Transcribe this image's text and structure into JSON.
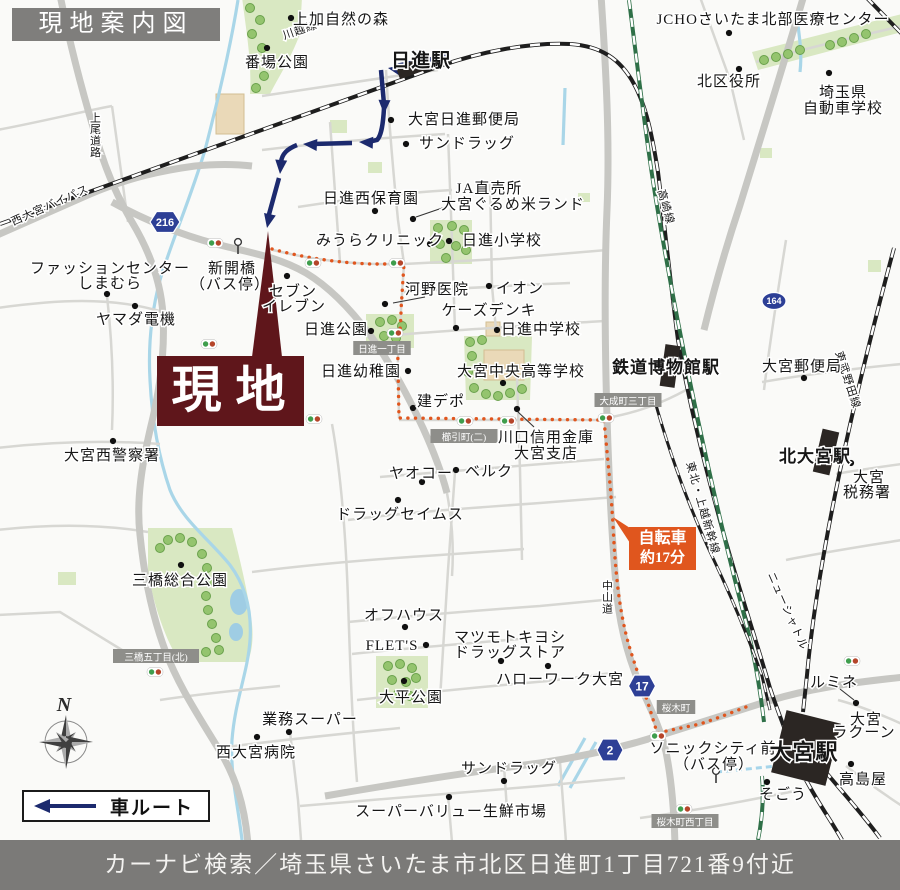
{
  "header": {
    "title": "現地案内図"
  },
  "footer": {
    "text": "カーナビ検索／埼玉県さいたま市北区日進町1丁目721番9付近"
  },
  "site": {
    "label": "現地"
  },
  "legend": {
    "label": "車ルート"
  },
  "bike_badge": {
    "line1": "自転車",
    "line2": "約17分"
  },
  "compass": {
    "label": "N",
    "x": 66,
    "y": 742
  },
  "colors": {
    "site_maroon": "#5f161b",
    "route_navy": "#1c2a6e",
    "bike_orange": "#e0561e",
    "shield_blue": "#2d3f96",
    "bar_gray": "#7b7a78",
    "road_gray": "#c7c7c3",
    "park_green": "#d9e8c2",
    "river_blue": "#a9d6e8",
    "rail_black": "#1e1e1e",
    "shinkansen_green": "#2f7048"
  },
  "map": {
    "roads_major": [
      "M60,-5 C72,55 86,105 100,150 C108,175 118,198 132,222 C150,252 161,282 163,315 C165,350 160,390 150,430 C142,465 136,500 140,535 C144,575 152,615 165,650 C178,685 198,715 218,748 C235,775 245,805 248,845",
      "M-5,236 L90,194 C130,177 165,170 195,166 C215,164 235,164 252,166",
      "M112,202 C152,224 190,238 228,247 C258,254 282,259 306,273 C331,288 352,311 370,335 C392,365 409,398 423,428 C433,450 441,470 447,493",
      "M601,-5 C606,70 610,140 607,210 C604,280 605,350 607,417 C609,480 612,540 616,585 C619,625 629,662 644,694 C653,714 661,731 666,752 C671,777 674,806 675,845",
      "M325,796 C400,783 470,772 540,763 C580,757 620,748 658,736 C700,723 740,710 772,700 C805,690 845,683 905,677",
      "M804,-5 C782,70 760,140 740,205 C726,247 714,289 704,330"
    ],
    "roads_minor": [
      "M-3,130 C40,122 80,112 112,106",
      "M112,106 L128,222",
      "M262,96 C330,86 380,78 438,70",
      "M-3,308 C55,300 110,296 163,312",
      "M107,296 C112,340 114,385 112,430",
      "M-3,448 C50,442 105,440 160,444",
      "M-3,530 C50,524 100,524 148,532",
      "M330,122 L340,262",
      "M386,70 C388,106 392,160 398,220 L404,264",
      "M262,150 C320,143 380,138 445,134",
      "M298,207 C350,199 400,193 452,190",
      "M273,250 C320,262 365,265 404,264 L500,259 L607,250",
      "M448,134 L452,241 L455,330",
      "M490,180 L492,286 L496,330",
      "M404,292 C450,289 520,285 570,283",
      "M396,335 C450,330 540,325 604,321",
      "M404,264 L401,310 C401,332 397,348 398,368 L399,418",
      "M399,420 L604,420",
      "M607,418 C640,412 664,402 686,390",
      "M332,424 C342,480 346,540 348,600 C350,660 352,720 357,782",
      "M517,378 L520,470 L522,560",
      "M380,477 C440,472 520,466 604,459",
      "M455,472 L448,570 L443,650 L440,700",
      "M348,520 C400,513 470,508 540,503 L616,497",
      "M252,572 C300,566 360,560 440,555 L524,549",
      "M348,622 C400,617 470,611 540,606 L614,599",
      "M352,654 C400,649 460,644 520,639",
      "M357,700 C420,693 480,687 548,681 L612,673",
      "M290,732 L298,800 L301,840",
      "M218,748 C280,740 340,734 400,728",
      "M300,806 C380,799 460,792 540,786 L625,778",
      "M560,762 L566,842",
      "M448,796 L452,842",
      "M504,766 L507,810",
      "M160,700 C200,694 240,690 280,686",
      "M-3,615 L60,612 L122,650",
      "M756,62 C800,50 850,38 902,26",
      "M700,-3 L730,80 L744,140",
      "M762,382 C810,374 860,368 902,364",
      "M836,474 C858,470 880,467 902,464",
      "M786,560 C825,552 865,546 902,540",
      "M838,700 C860,706 880,714 902,724",
      "M846,766 C864,780 884,794 902,806",
      "M640,818 C700,810 750,800 800,790",
      "M786,240 C778,290 770,340 764,390",
      "M447,493 C452,520 454,548 452,576"
    ],
    "railways": [
      {
        "d": "M0,224 L440,66 C480,52 530,42 570,44 C600,46 620,58 634,84 C646,106 652,134 658,172 C664,220 670,280 678,340 C690,408 706,470 724,535 C740,592 756,640 770,688 C778,712 785,730 792,748",
        "k": "jr"
      },
      {
        "d": "M629,0 C638,70 646,140 656,200 C668,272 682,345 698,420 C712,485 728,555 744,615 C754,652 760,688 764,722",
        "k": "sk"
      },
      {
        "d": "M894,248 C872,330 850,420 834,500 C822,560 812,620 807,675 L803,712",
        "k": "jr"
      },
      {
        "d": "M866,-3 L902,34",
        "k": "jr"
      },
      {
        "d": "M654,398 C668,448 688,505 712,556 C730,594 748,636 762,676 L770,710",
        "k": "lrt"
      },
      {
        "d": "M824,770 C845,795 864,816 880,838",
        "k": "jr"
      },
      {
        "d": "M806,780 C820,806 832,822 842,840",
        "k": "jr"
      },
      {
        "d": "M762,776 C764,798 762,820 758,840",
        "k": "sk"
      }
    ],
    "rivers": [
      "M238,0 C230,50 218,100 205,150 C190,200 172,240 160,280 C152,310 148,345 150,380 C152,420 158,455 170,490 C182,520 210,540 230,565 C245,585 252,610 250,640 C248,672 235,700 232,740 C230,775 238,805 242,840",
      "M565,88 L563,145",
      "M797,18 C800,40 802,55 800,72",
      "M585,738 L558,786",
      "M596,742 L570,788"
    ],
    "walk_link": "M716,772 C740,770 765,767 788,765",
    "parks": [
      "M242,-3 L302,-3 L300,34 C290,60 278,78 270,94 L250,94 C252,62 246,30 242,-3 Z",
      "M430,220 L472,220 L472,264 L430,264 Z",
      "M366,314 L414,314 L414,348 L366,348 Z",
      "M464,336 L532,336 L530,400 L466,400 Z",
      "M148,528 L232,528 C240,560 248,592 252,624 C254,644 250,660 246,662 L180,662 C165,640 152,600 148,570 Z",
      "M376,656 L428,656 L428,708 L376,708 Z",
      "M752,52 L902,14 L902,32 L758,70 Z"
    ],
    "green_rects": [
      [
        330,
        120,
        17,
        13
      ],
      [
        368,
        162,
        14,
        11
      ],
      [
        578,
        193,
        12,
        9
      ],
      [
        868,
        260,
        13,
        12
      ],
      [
        58,
        572,
        18,
        13
      ],
      [
        282,
        24,
        14,
        12
      ],
      [
        760,
        148,
        12,
        10
      ]
    ],
    "ponds": [
      [
        239,
        602,
        9,
        13
      ],
      [
        236,
        632,
        7,
        9
      ]
    ],
    "buildings": [
      [
        216,
        94,
        28,
        40
      ],
      [
        484,
        350,
        40,
        30
      ],
      [
        486,
        322,
        14,
        14
      ]
    ],
    "trees": [
      [
        250,
        8
      ],
      [
        260,
        20
      ],
      [
        252,
        34
      ],
      [
        262,
        48
      ],
      [
        254,
        62
      ],
      [
        264,
        76
      ],
      [
        256,
        88
      ],
      [
        438,
        228
      ],
      [
        452,
        226
      ],
      [
        464,
        230
      ],
      [
        440,
        244
      ],
      [
        456,
        246
      ],
      [
        466,
        250
      ],
      [
        446,
        258
      ],
      [
        380,
        322
      ],
      [
        392,
        320
      ],
      [
        402,
        326
      ],
      [
        384,
        336
      ],
      [
        396,
        338
      ],
      [
        470,
        342
      ],
      [
        482,
        340
      ],
      [
        472,
        356
      ],
      [
        468,
        372
      ],
      [
        474,
        388
      ],
      [
        486,
        394
      ],
      [
        498,
        396
      ],
      [
        510,
        393
      ],
      [
        522,
        389
      ],
      [
        168,
        540
      ],
      [
        180,
        538
      ],
      [
        192,
        542
      ],
      [
        202,
        554
      ],
      [
        207,
        568
      ],
      [
        209,
        582
      ],
      [
        206,
        596
      ],
      [
        208,
        610
      ],
      [
        212,
        624
      ],
      [
        216,
        638
      ],
      [
        219,
        650
      ],
      [
        206,
        652
      ],
      [
        160,
        548
      ],
      [
        388,
        666
      ],
      [
        400,
        664
      ],
      [
        412,
        668
      ],
      [
        392,
        680
      ],
      [
        406,
        682
      ],
      [
        416,
        678
      ],
      [
        398,
        694
      ],
      [
        410,
        696
      ],
      [
        764,
        60
      ],
      [
        776,
        57
      ],
      [
        788,
        54
      ],
      [
        800,
        50
      ],
      [
        830,
        45
      ],
      [
        842,
        42
      ],
      [
        854,
        38
      ],
      [
        866,
        34
      ]
    ],
    "bike_route": "M272,249 C305,258 340,263 372,264 L404,264 L401,310 C401,332 397,348 398,368 L399,418 L604,420 C607,452 611,490 613,525 C615,565 618,605 628,642 C636,670 648,700 657,733 L700,724 C718,718 733,712 746,707",
    "car_route": {
      "lines": [
        "M448,56 L396,66",
        "M381,70 L384,104",
        "M384,108 C383,126 381,136 377,140 L368,142",
        "M352,143 L312,144",
        "M297,145 C287,149 282,154 281,162 L280,164",
        "M279,178 L268,218"
      ],
      "arrows": [
        [
          388,
          68,
          190
        ],
        [
          384,
          114,
          92
        ],
        [
          359,
          142,
          183
        ],
        [
          303,
          144,
          184
        ],
        [
          280,
          174,
          95
        ],
        [
          267,
          228,
          102
        ]
      ]
    },
    "site_pointer": "268,231 252,357 282,357",
    "badge_pointer": "630,528 613,517 630,543",
    "stations": [
      [
        412,
        68,
        30,
        13,
        -20
      ],
      [
        670,
        366,
        15,
        42,
        8
      ],
      [
        826,
        452,
        17,
        44,
        13
      ],
      [
        806,
        748,
        56,
        64,
        14
      ]
    ],
    "shields": [
      {
        "n": "216",
        "x": 165,
        "y": 222,
        "k": "hex",
        "w": 30,
        "h": 21,
        "fs": 11
      },
      {
        "n": "164",
        "x": 774,
        "y": 301,
        "k": "oval",
        "w": 24,
        "h": 17,
        "fs": 9
      },
      {
        "n": "17",
        "x": 642,
        "y": 686,
        "k": "hex",
        "w": 27,
        "h": 22,
        "fs": 12
      },
      {
        "n": "2",
        "x": 610,
        "y": 750,
        "k": "hex",
        "w": 26,
        "h": 22,
        "fs": 12
      }
    ],
    "area_tags": [
      [
        "日進一丁目",
        382,
        349
      ],
      [
        "櫛引町(二)",
        464,
        437
      ],
      [
        "大成町三丁目",
        628,
        401
      ],
      [
        "三橋五丁目(北)",
        156,
        657
      ],
      [
        "桜木町",
        676,
        708
      ],
      [
        "桜木町西丁目",
        685,
        822
      ]
    ],
    "signals": [
      [
        215,
        243
      ],
      [
        313,
        263
      ],
      [
        397,
        263
      ],
      [
        395,
        333
      ],
      [
        209,
        344
      ],
      [
        314,
        419
      ],
      [
        465,
        421
      ],
      [
        508,
        421
      ],
      [
        606,
        418
      ],
      [
        155,
        672
      ],
      [
        658,
        736
      ],
      [
        684,
        809
      ],
      [
        852,
        661
      ]
    ],
    "bus_stops": [
      [
        238,
        249
      ],
      [
        716,
        778
      ]
    ],
    "dots": [
      [
        291,
        18
      ],
      [
        267,
        48
      ],
      [
        729,
        33
      ],
      [
        739,
        69
      ],
      [
        829,
        73
      ],
      [
        391,
        120
      ],
      [
        406,
        144
      ],
      [
        375,
        211
      ],
      [
        413,
        219
      ],
      [
        430,
        244
      ],
      [
        449,
        241
      ],
      [
        385,
        304
      ],
      [
        489,
        286
      ],
      [
        456,
        328
      ],
      [
        497,
        330
      ],
      [
        371,
        331
      ],
      [
        287,
        276
      ],
      [
        107,
        294
      ],
      [
        135,
        306
      ],
      [
        113,
        441
      ],
      [
        408,
        371
      ],
      [
        503,
        383
      ],
      [
        413,
        408
      ],
      [
        517,
        409
      ],
      [
        456,
        470
      ],
      [
        422,
        482
      ],
      [
        398,
        500
      ],
      [
        181,
        565
      ],
      [
        405,
        627
      ],
      [
        426,
        645
      ],
      [
        501,
        661
      ],
      [
        548,
        666
      ],
      [
        404,
        681
      ],
      [
        289,
        732
      ],
      [
        257,
        737
      ],
      [
        504,
        781
      ],
      [
        449,
        797
      ],
      [
        804,
        378
      ],
      [
        851,
        463
      ],
      [
        856,
        703
      ],
      [
        851,
        764
      ],
      [
        767,
        782
      ]
    ],
    "leaders": [
      [
        448,
        206,
        416,
        217
      ],
      [
        518,
        412,
        534,
        427
      ],
      [
        425,
        297,
        393,
        303
      ],
      [
        840,
        689,
        854,
        700
      ]
    ],
    "labels": [
      {
        "t": "上加自然の森",
        "x": 341,
        "y": 19
      },
      {
        "t": "番場公園",
        "x": 277,
        "y": 62
      },
      {
        "t": "日進駅",
        "x": 421,
        "y": 60,
        "s": 19,
        "b": 1
      },
      {
        "t": "JCHOさいたま北部医療センター",
        "x": 773,
        "y": 19
      },
      {
        "t": "北区役所",
        "x": 729,
        "y": 81
      },
      {
        "t": "埼玉県",
        "x": 843,
        "y": 92
      },
      {
        "t": "自動車学校",
        "x": 843,
        "y": 108
      },
      {
        "t": "大宮日進郵便局",
        "x": 464,
        "y": 119
      },
      {
        "t": "サンドラッグ",
        "x": 467,
        "y": 143
      },
      {
        "t": "日進西保育園",
        "x": 371,
        "y": 198
      },
      {
        "t": "JA直売所",
        "x": 489,
        "y": 188
      },
      {
        "t": "大宮ぐるめ米ランド",
        "x": 513,
        "y": 204
      },
      {
        "t": "みうらクリニック",
        "x": 380,
        "y": 240
      },
      {
        "t": "日進小学校",
        "x": 502,
        "y": 240
      },
      {
        "t": "河野医院",
        "x": 437,
        "y": 289
      },
      {
        "t": "イオン",
        "x": 520,
        "y": 288
      },
      {
        "t": "ケーズデンキ",
        "x": 489,
        "y": 310
      },
      {
        "t": "日進中学校",
        "x": 541,
        "y": 329
      },
      {
        "t": "日進公園",
        "x": 336,
        "y": 329
      },
      {
        "t": "セブン",
        "x": 293,
        "y": 291
      },
      {
        "t": "イレブン",
        "x": 294,
        "y": 306
      },
      {
        "t": "新開橋",
        "x": 232,
        "y": 268
      },
      {
        "t": "（バス停）",
        "x": 230,
        "y": 284
      },
      {
        "t": "ファッションセンター",
        "x": 110,
        "y": 268
      },
      {
        "t": "しまむら",
        "x": 110,
        "y": 283
      },
      {
        "t": "ヤマダ電機",
        "x": 136,
        "y": 319
      },
      {
        "t": "日進幼稚園",
        "x": 361,
        "y": 371
      },
      {
        "t": "大宮中央高等学校",
        "x": 521,
        "y": 371
      },
      {
        "t": "建デポ",
        "x": 441,
        "y": 401
      },
      {
        "t": "川口信用金庫",
        "x": 546,
        "y": 437
      },
      {
        "t": "大宮支店",
        "x": 546,
        "y": 453
      },
      {
        "t": "ヤオコー",
        "x": 421,
        "y": 473
      },
      {
        "t": "ベルク",
        "x": 489,
        "y": 471
      },
      {
        "t": "ドラッグセイムス",
        "x": 400,
        "y": 514
      },
      {
        "t": "三橋総合公園",
        "x": 180,
        "y": 580
      },
      {
        "t": "オフハウス",
        "x": 404,
        "y": 615
      },
      {
        "t": "FLET'S",
        "x": 392,
        "y": 645
      },
      {
        "t": "マツモトキヨシ",
        "x": 510,
        "y": 637
      },
      {
        "t": "ドラッグストア",
        "x": 510,
        "y": 652
      },
      {
        "t": "ハローワーク大宮",
        "x": 560,
        "y": 679
      },
      {
        "t": "大平公園",
        "x": 411,
        "y": 697
      },
      {
        "t": "業務スーパー",
        "x": 310,
        "y": 719
      },
      {
        "t": "西大宮病院",
        "x": 256,
        "y": 752
      },
      {
        "t": "大宮西警察署",
        "x": 112,
        "y": 455
      },
      {
        "t": "サンドラッグ",
        "x": 509,
        "y": 768
      },
      {
        "t": "スーパーバリュー生鮮市場",
        "x": 451,
        "y": 811
      },
      {
        "t": "鉄道博物館駅",
        "x": 666,
        "y": 367,
        "s": 17,
        "b": 1
      },
      {
        "t": "大宮郵便局",
        "x": 802,
        "y": 366
      },
      {
        "t": "北大宮駅",
        "x": 815,
        "y": 456,
        "s": 17,
        "b": 1
      },
      {
        "t": "大宮",
        "x": 869,
        "y": 477
      },
      {
        "t": "税務署",
        "x": 867,
        "y": 492
      },
      {
        "t": "ルミネ",
        "x": 834,
        "y": 682
      },
      {
        "t": "大宮",
        "x": 866,
        "y": 719
      },
      {
        "t": "ラクーン",
        "x": 864,
        "y": 732
      },
      {
        "t": "高島屋",
        "x": 863,
        "y": 779
      },
      {
        "t": "そごう",
        "x": 783,
        "y": 794
      },
      {
        "t": "ソニックシティ前",
        "x": 713,
        "y": 748
      },
      {
        "t": "（バス停）",
        "x": 714,
        "y": 764
      },
      {
        "t": "大宮駅",
        "x": 804,
        "y": 752,
        "s": 22,
        "b": 1
      }
    ],
    "rail_labels": [
      {
        "t": "川越線",
        "x": 300,
        "y": 30,
        "r": -19
      },
      {
        "t": "高崎線",
        "x": 666,
        "y": 207,
        "r": 74
      },
      {
        "t": "東北・上越新幹線",
        "x": 703,
        "y": 508,
        "r": 74
      },
      {
        "t": "ニューシャトル",
        "x": 788,
        "y": 611,
        "r": 66
      },
      {
        "t": "東武野田線",
        "x": 848,
        "y": 380,
        "r": 72
      },
      {
        "t": "西大宮バイパス",
        "x": 50,
        "y": 205,
        "r": -24
      },
      {
        "t": "中山道",
        "x": 608,
        "y": 586,
        "v": 1
      },
      {
        "t": "上尾道路",
        "x": 96,
        "y": 118,
        "v": 1
      }
    ]
  }
}
